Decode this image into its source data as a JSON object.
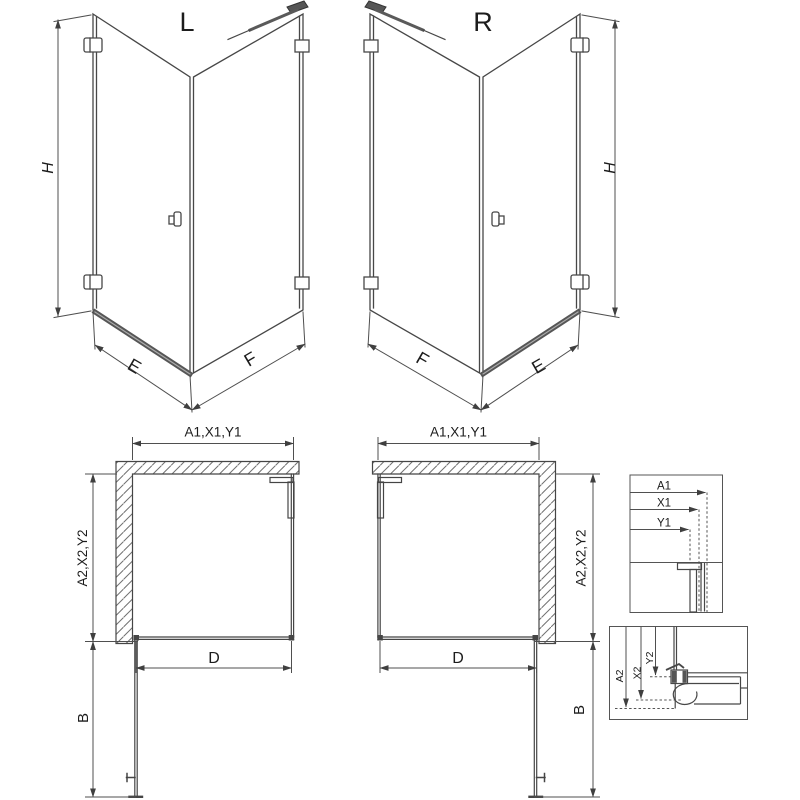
{
  "drawing": {
    "iso_left": {
      "title": "L",
      "dim_height": "H",
      "dim_door_width": "E",
      "dim_panel_width": "F"
    },
    "iso_right": {
      "title": "R",
      "dim_height": "H",
      "dim_door_width": "E",
      "dim_panel_width": "F"
    },
    "plan_left": {
      "dim_top": "A1,X1,Y1",
      "dim_side": "A2,X2,Y2",
      "dim_door": "D",
      "dim_swing": "B"
    },
    "plan_right": {
      "dim_top": "A1,X1,Y1",
      "dim_side": "A2,X2,Y2",
      "dim_door": "D",
      "dim_swing": "B"
    },
    "detail_top": {
      "dims": [
        "A1",
        "X1",
        "Y1"
      ]
    },
    "detail_bottom": {
      "dims": [
        "A2",
        "X2",
        "Y2"
      ]
    }
  },
  "colors": {
    "line": "#474747",
    "dim_line": "#4f4f4f",
    "hatch": "#707070",
    "threshold": "#565656",
    "background": "#ffffff"
  }
}
